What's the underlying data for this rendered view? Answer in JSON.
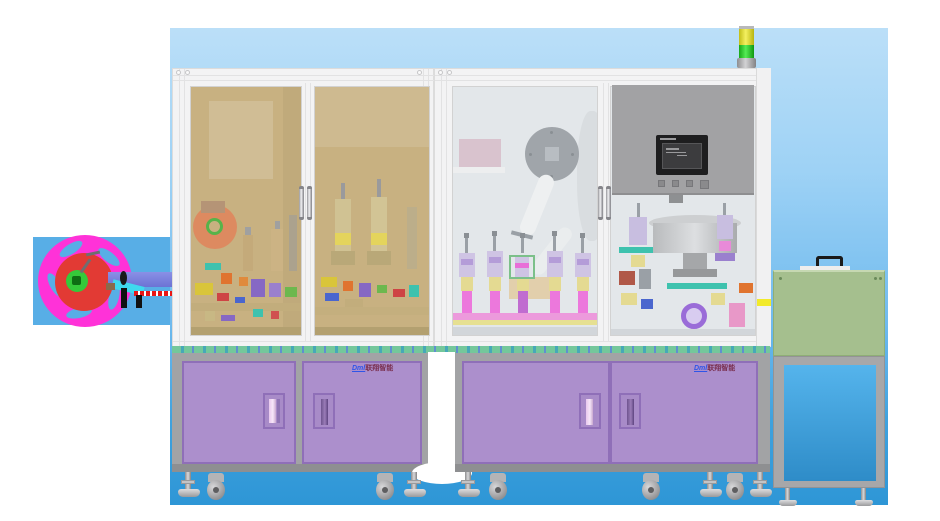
{
  "branding": {
    "left_cabinet": {
      "prefix": "Dml",
      "name": "联翔智能"
    },
    "right_cabinet": {
      "prefix": "Dml",
      "name": "联翔智能"
    }
  },
  "tower_light": {
    "segments": [
      "yellow",
      "green"
    ]
  },
  "colors": {
    "sky_top": "#BBDFF8",
    "sky_bottom": "#2E96D6",
    "feeder_panel_blue": "#58AEE6",
    "reel_magenta": "#FF32D8",
    "reel_red": "#E23A34",
    "reel_hub_green": "#35C93A",
    "enclosure_frame": "#F3F3F4",
    "left_window_tint": "#C8B181",
    "right_window_tint": "#E3E7EA",
    "control_panel_gray": "#A2A2A4",
    "hmi_bezel": "#1E1E1F",
    "cabinet_gray": "#A2A3A5",
    "door_purple": "#AC8FCC",
    "door_trim_purple": "#8F6FB8",
    "top_strip_green": "#74C79B",
    "side_box_green": "#A5BF8E",
    "side_box_panel_blue": "#3FA2DE",
    "tower_yellow": "#E8E432",
    "tower_green": "#2ECC2E"
  }
}
